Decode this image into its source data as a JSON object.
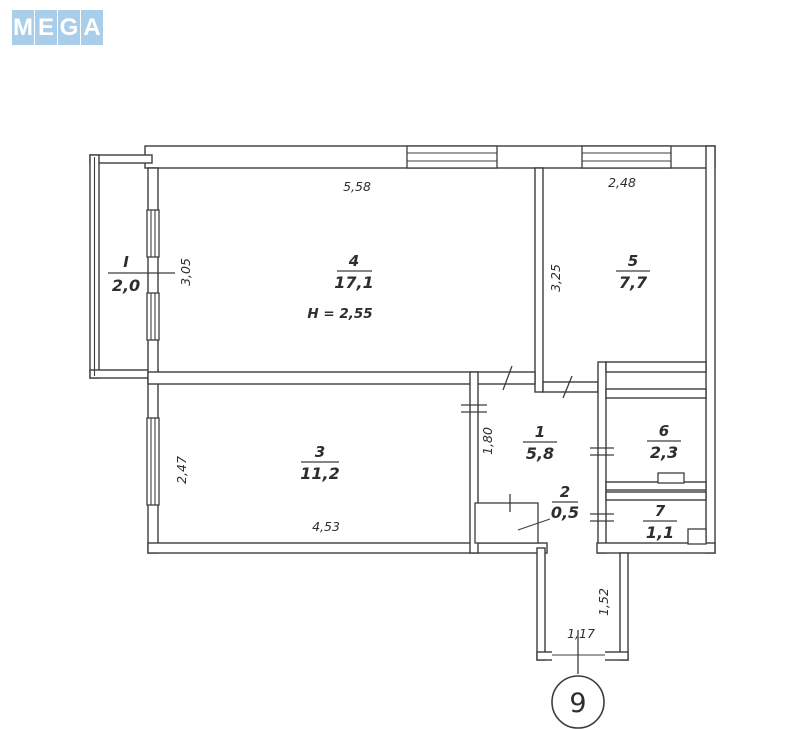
{
  "logo": {
    "letters": [
      "M",
      "E",
      "G",
      "A"
    ],
    "tile_color": "#a9cee9",
    "letter_color": "#ffffff"
  },
  "plan": {
    "line_color": "#3d3d3d",
    "rooms": {
      "balcony": {
        "number": "I",
        "area": "2,0"
      },
      "room4": {
        "number": "4",
        "area": "17,1"
      },
      "room5": {
        "number": "5",
        "area": "7,7"
      },
      "room3": {
        "number": "3",
        "area": "11,2"
      },
      "hall1": {
        "number": "1",
        "area": "5,8"
      },
      "closet2": {
        "number": "2",
        "area": "0,5"
      },
      "room6": {
        "number": "6",
        "area": "2,3"
      },
      "room7": {
        "number": "7",
        "area": "1,1"
      }
    },
    "height_note": "H = 2,55",
    "dims": {
      "room4_width": "5,58",
      "room4_depth": "3,05",
      "room5_width": "2,48",
      "room5_depth": "3,25",
      "room3_depth": "2,47",
      "room3_width": "4,53",
      "hall_depth": "1,80",
      "entry_depth": "1,52",
      "entry_width": "1,17"
    },
    "floor_badge": "9"
  }
}
